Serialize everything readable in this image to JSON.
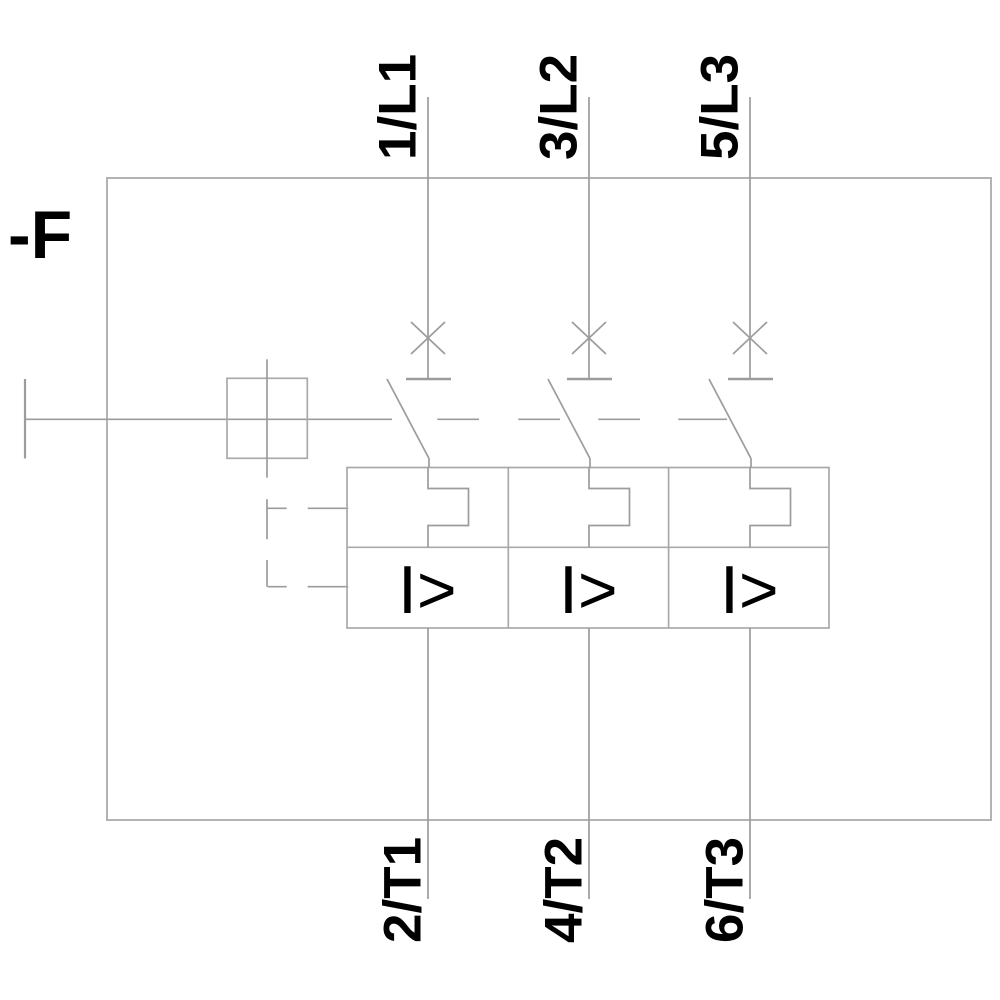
{
  "diagram": {
    "device_label": "-F",
    "overcurrent_symbol": "I>",
    "poles": [
      {
        "top": "1/L1",
        "bottom": "2/T1"
      },
      {
        "top": "3/L2",
        "bottom": "4/T2"
      },
      {
        "top": "5/L3",
        "bottom": "6/T3"
      }
    ],
    "colors": {
      "line": "#9c9c9c",
      "outer_box": "#b3b3b3",
      "block": "#a9a9a9",
      "label": "#000000",
      "background": "#ffffff"
    }
  }
}
